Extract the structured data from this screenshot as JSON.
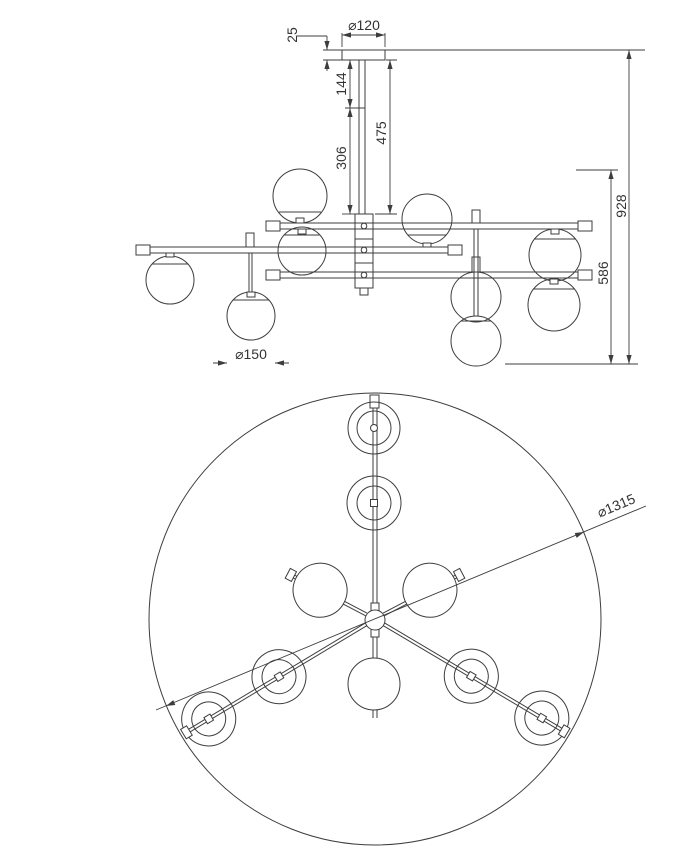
{
  "drawing": {
    "type": "technical-dimension-drawing",
    "subject": "chandelier ceiling lamp",
    "colors": {
      "line": "#3d3d3d",
      "text": "#333333",
      "background": "#ffffff"
    },
    "views": {
      "elevation": {
        "name": "side elevation",
        "dimensions": {
          "canopy_diameter": "⌀120",
          "canopy_height": "25",
          "rod_upper_segment": "144",
          "rod_lower_segment": "306",
          "rod_total": "475",
          "overall_height": "928",
          "body_height": "586",
          "globe_diameter": "⌀150"
        }
      },
      "plan": {
        "name": "bottom plan",
        "dimensions": {
          "overall_diameter": "⌀1315"
        }
      }
    }
  }
}
